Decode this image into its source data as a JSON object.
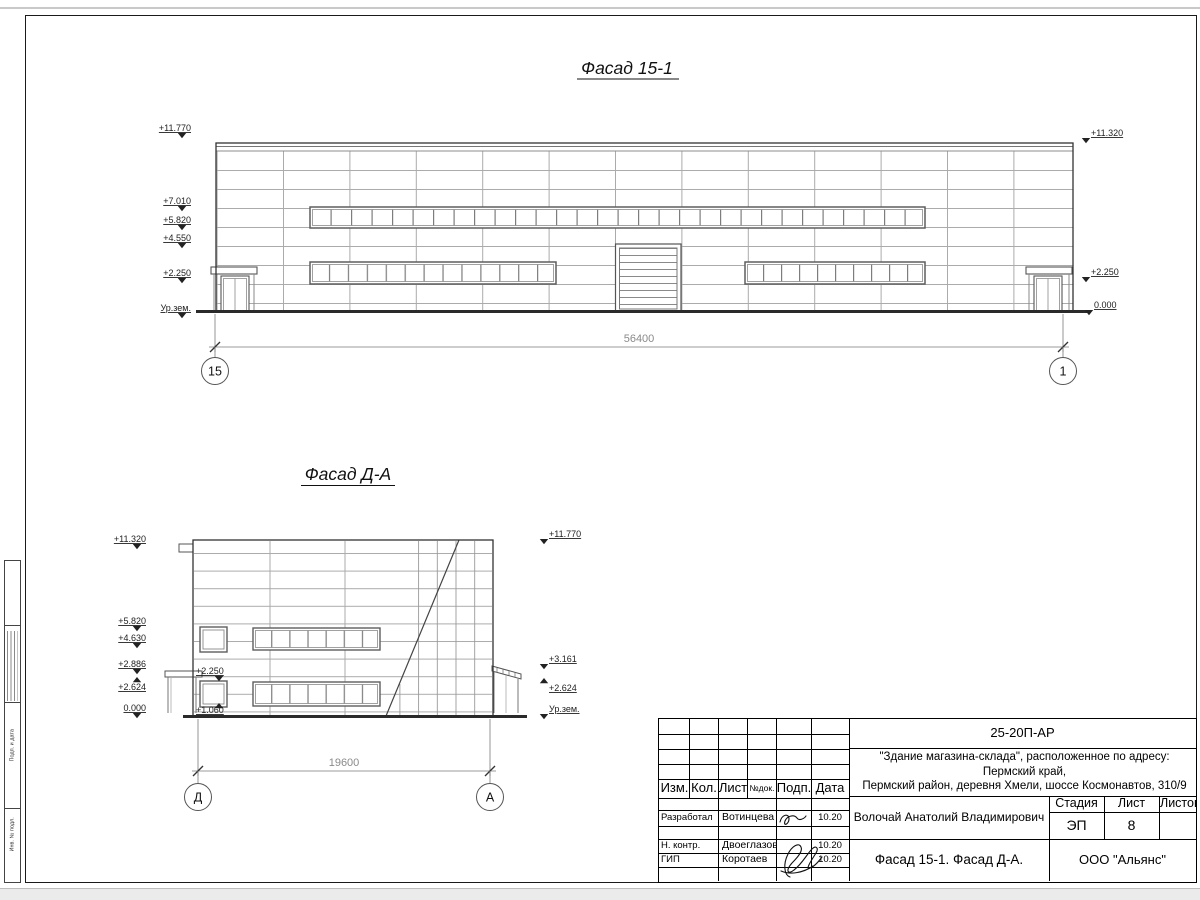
{
  "facade1": {
    "title": "Фасад 15-1",
    "marks_left": [
      "+11.770",
      "+7.010",
      "+5.820",
      "+4.550",
      "+2.250",
      "Ур.зем."
    ],
    "marks_right": [
      "+11.320",
      "+2.250",
      "0.000"
    ],
    "dimension": "56400",
    "axis_left": "15",
    "axis_right": "1"
  },
  "facade2": {
    "title": "Фасад Д-А",
    "marks_left": [
      "+11.320",
      "+5.820",
      "+4.630",
      "+2.886",
      "+2.624",
      "0.000"
    ],
    "marks_inner": [
      "+2.250",
      "+1.060"
    ],
    "marks_right": [
      "+11.770",
      "+3.161",
      "+2.624",
      "Ур.зем."
    ],
    "dimension": "19600",
    "axis_left": "Д",
    "axis_right": "А"
  },
  "titleblock": {
    "code": "25-20П-АР",
    "project_line1": "\"Здание магазина-склада\", расположенное по адресу: Пермский край,",
    "project_line2": "Пермский район, деревня Хмели, шоссе Космонавтов, 310/9",
    "columns": [
      "Изм.",
      "Кол.",
      "Лист",
      "№док.",
      "Подп.",
      "Дата"
    ],
    "rows": [
      {
        "role": "Разработал",
        "name": "Вотинцева",
        "date": "10.20"
      },
      {
        "role": "Н. контр.",
        "name": "Двоеглазов",
        "date": "10.20"
      },
      {
        "role": "ГИП",
        "name": "Коротаев",
        "date": "10.20"
      }
    ],
    "approved_by": "Волочай Анатолий Владимирович",
    "stage_label": "Стадия",
    "sheet_label": "Лист",
    "sheets_label": "Листов",
    "stage": "ЭП",
    "sheet": "8",
    "drawing_title": "Фасад 15-1. Фасад Д-А.",
    "company": "ООО \"Альянс\""
  },
  "side_strip": {
    "labels": [
      "Подп. и дата",
      "Инв. № подл."
    ]
  }
}
